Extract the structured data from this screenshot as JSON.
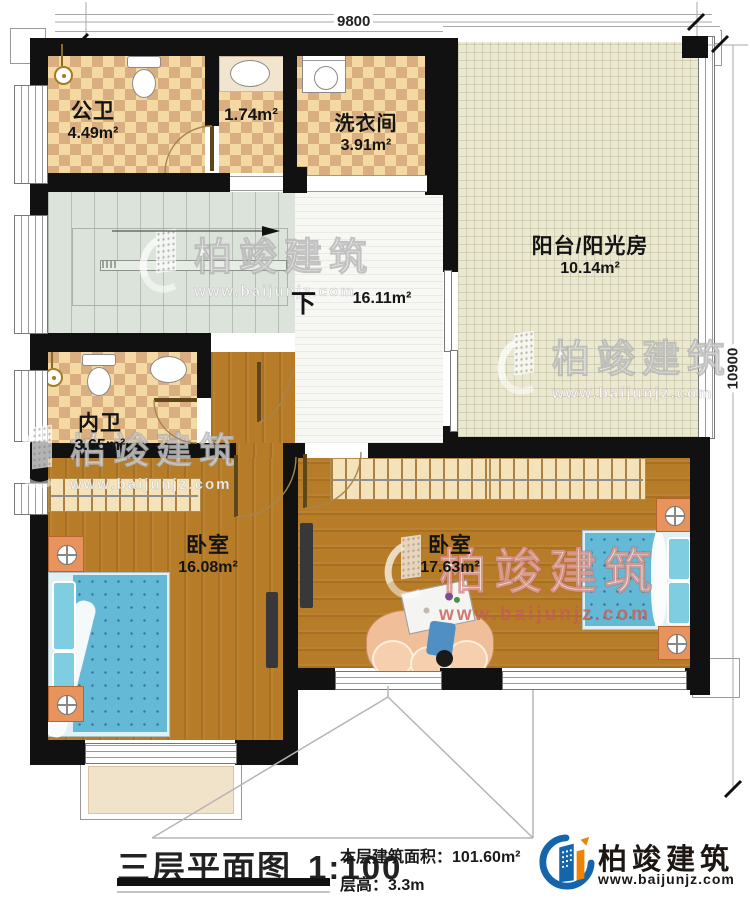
{
  "dimensions": {
    "top": "9800",
    "right": "10900"
  },
  "rooms": {
    "public_bath": {
      "name": "公卫",
      "area": "4.49m²"
    },
    "wc": {
      "area": "1.74m²"
    },
    "laundry": {
      "name": "洗衣间",
      "area": "3.91m²"
    },
    "balcony": {
      "name": "阳台/阳光房",
      "area": "10.14m²"
    },
    "hall": {
      "area": "16.11m²",
      "stair_direction": "下"
    },
    "ensuite_bath": {
      "name": "内卫",
      "area": "3.65m²"
    },
    "bedroom_left": {
      "name": "卧室",
      "area": "16.08m²"
    },
    "bedroom_right": {
      "name": "卧室",
      "area": "17.63m²"
    }
  },
  "title_block": {
    "title": "三层平面图",
    "scale": "1:100",
    "area_label": "本层建筑面积：",
    "area_value": "101.60m²",
    "height_label": "层高：",
    "height_value": "3.3m"
  },
  "brand": {
    "name": "柏竣建筑",
    "url": "www.baijunjz.com"
  },
  "colors": {
    "wall": "#111111",
    "tile_light": "#f5d9a2",
    "tile_dark": "#d9ae80",
    "wood": "#b67c28",
    "stairs": "#dce3da",
    "hall_tile": "#f7f7f4",
    "balcony_floor": "#ebe8d2",
    "bed_blue": "#64b9d6",
    "brand_blue": "#1565ad",
    "brand_orange": "#f08300",
    "watermark_red": "#c45c54"
  }
}
